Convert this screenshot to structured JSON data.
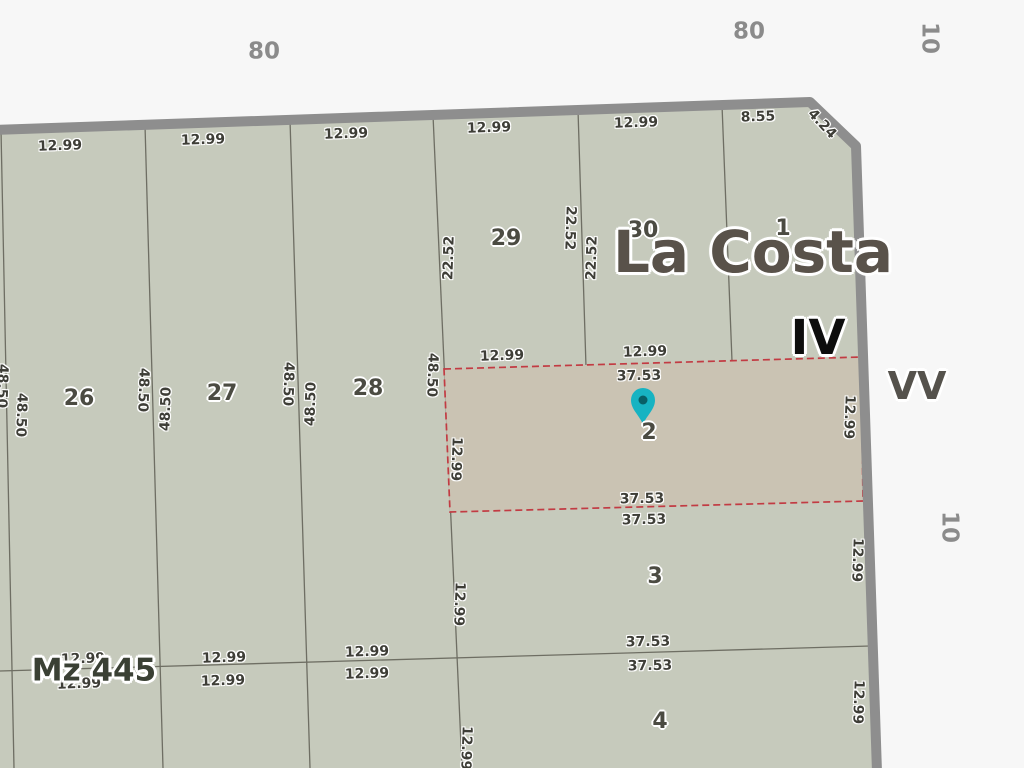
{
  "map": {
    "area_name": "La Costa",
    "section_number": "IV",
    "block_number": "Mz 445",
    "road_name": "VV",
    "highlighted_lot": "2",
    "colors": {
      "background": "#f7f7f7",
      "block_fill": "#c6cabc",
      "highlight_fill": "#cac3b3",
      "highlight_border": "#c23b43",
      "road_stroke": "#8e8e8e",
      "parcel_line": "#6e6e63",
      "pin_fill": "#17b3c2",
      "pin_center": "#085f66"
    },
    "street_numbers": [
      {
        "text": "80",
        "x": 264,
        "y": 52,
        "rot": 0
      },
      {
        "text": "80",
        "x": 749,
        "y": 32,
        "rot": 0
      },
      {
        "text": "10",
        "x": 929,
        "y": 38,
        "rot": 90
      },
      {
        "text": "10",
        "x": 949,
        "y": 527,
        "rot": 90
      }
    ],
    "lot_numbers": [
      {
        "text": "26",
        "x": 79,
        "y": 399,
        "rot": 0
      },
      {
        "text": "27",
        "x": 222,
        "y": 394,
        "rot": 0
      },
      {
        "text": "28",
        "x": 368,
        "y": 389,
        "rot": 0
      },
      {
        "text": "29",
        "x": 506,
        "y": 239,
        "rot": 0
      },
      {
        "text": "30",
        "x": 643,
        "y": 231,
        "rot": 0
      },
      {
        "text": "1",
        "x": 783,
        "y": 229,
        "rot": 0
      },
      {
        "text": "2",
        "x": 649,
        "y": 433,
        "rot": 0
      },
      {
        "text": "3",
        "x": 655,
        "y": 577,
        "rot": 0
      },
      {
        "text": "4",
        "x": 660,
        "y": 722,
        "rot": 0
      }
    ],
    "dimensions": [
      {
        "text": "12.99",
        "x": 60,
        "y": 146,
        "rot": -2
      },
      {
        "text": "12.99",
        "x": 203,
        "y": 140,
        "rot": -2
      },
      {
        "text": "12.99",
        "x": 346,
        "y": 134,
        "rot": -2
      },
      {
        "text": "12.99",
        "x": 489,
        "y": 128,
        "rot": -2
      },
      {
        "text": "12.99",
        "x": 636,
        "y": 123,
        "rot": -2
      },
      {
        "text": "8.55",
        "x": 758,
        "y": 117,
        "rot": -2
      },
      {
        "text": "4.24",
        "x": 822,
        "y": 124,
        "rot": 47
      },
      {
        "text": "22.52",
        "x": 449,
        "y": 258,
        "rot": -88
      },
      {
        "text": "22.52",
        "x": 570,
        "y": 228,
        "rot": 92
      },
      {
        "text": "22.52",
        "x": 592,
        "y": 258,
        "rot": -88
      },
      {
        "text": "48.50",
        "x": 2,
        "y": 386,
        "rot": 92
      },
      {
        "text": "48.50",
        "x": 21,
        "y": 415,
        "rot": 92
      },
      {
        "text": "48.50",
        "x": 143,
        "y": 390,
        "rot": 92
      },
      {
        "text": "48.50",
        "x": 166,
        "y": 409,
        "rot": -88
      },
      {
        "text": "48.50",
        "x": 288,
        "y": 384,
        "rot": 92
      },
      {
        "text": "48.50",
        "x": 311,
        "y": 404,
        "rot": -88
      },
      {
        "text": "48.50",
        "x": 432,
        "y": 375,
        "rot": 92
      },
      {
        "text": "12.99",
        "x": 456,
        "y": 459,
        "rot": 92
      },
      {
        "text": "12.99",
        "x": 459,
        "y": 604,
        "rot": 92
      },
      {
        "text": "12.99",
        "x": 466,
        "y": 748,
        "rot": 92
      },
      {
        "text": "12.99",
        "x": 849,
        "y": 417,
        "rot": 92
      },
      {
        "text": "12.99",
        "x": 857,
        "y": 560,
        "rot": 92
      },
      {
        "text": "12.99",
        "x": 858,
        "y": 702,
        "rot": 92
      },
      {
        "text": "12.99",
        "x": 502,
        "y": 356,
        "rot": -2
      },
      {
        "text": "12.99",
        "x": 645,
        "y": 352,
        "rot": -2
      },
      {
        "text": "37.53",
        "x": 639,
        "y": 376,
        "rot": -1
      },
      {
        "text": "37.53",
        "x": 642,
        "y": 499,
        "rot": -1
      },
      {
        "text": "37.53",
        "x": 644,
        "y": 520,
        "rot": -1
      },
      {
        "text": "37.53",
        "x": 648,
        "y": 642,
        "rot": -1
      },
      {
        "text": "37.53",
        "x": 650,
        "y": 666,
        "rot": -1
      },
      {
        "text": "12.99",
        "x": 83,
        "y": 659,
        "rot": -2
      },
      {
        "text": "12.99",
        "x": 79,
        "y": 684,
        "rot": -2
      },
      {
        "text": "12.99",
        "x": 224,
        "y": 658,
        "rot": -2
      },
      {
        "text": "12.99",
        "x": 223,
        "y": 681,
        "rot": -2
      },
      {
        "text": "12.99",
        "x": 367,
        "y": 652,
        "rot": -2
      },
      {
        "text": "12.99",
        "x": 367,
        "y": 674,
        "rot": -2
      }
    ]
  }
}
